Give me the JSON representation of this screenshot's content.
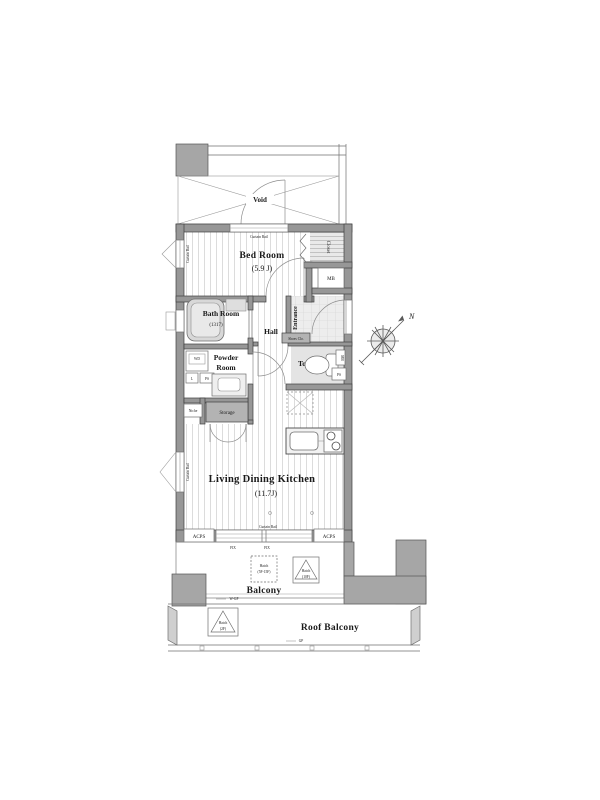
{
  "page": {
    "background": "#ffffff"
  },
  "colors": {
    "wall": "#979797",
    "outline": "#3f3f3f",
    "dark_box": "#b3b3b3",
    "floor_stripe": "#d9d9d9",
    "entrance_floor": "#ebebeb",
    "text": "#1a1a1a"
  },
  "plan": {
    "void_label": "Void",
    "curtain_rail": "Curtain Rail",
    "rooms": {
      "bed_room": {
        "name": "Bed Room",
        "size": "(5.9 J)"
      },
      "bath_room": {
        "name": "Bath Room",
        "size": "(1317)"
      },
      "powder_room": {
        "line1": "Powder",
        "line2": "Room"
      },
      "hall": "Hall",
      "entrance": "Entrance",
      "toilet": "Toilet",
      "ldk": {
        "name": "Living Dining Kitchen",
        "size": "(11.7J)"
      },
      "balcony": "Balcony",
      "roof_balcony": "Roof Balcony"
    },
    "fixtures": {
      "closet": "Closet",
      "mb": "MB",
      "shoes_closet": "Shoes Clo.",
      "storage": "Storage",
      "niche": "Niche",
      "wd": "WD",
      "laundry": "L",
      "ps": "PS",
      "acps": "ACPS",
      "fix": "FIX",
      "wgp": "W-GP",
      "gp": "GP"
    },
    "hatches": {
      "label": "Hatch",
      "balcony_a_sub": "(5F-15F)",
      "balcony_b_sub": "(10F)",
      "roof_sub": "(2F)"
    },
    "compass": {
      "north": "N"
    }
  }
}
